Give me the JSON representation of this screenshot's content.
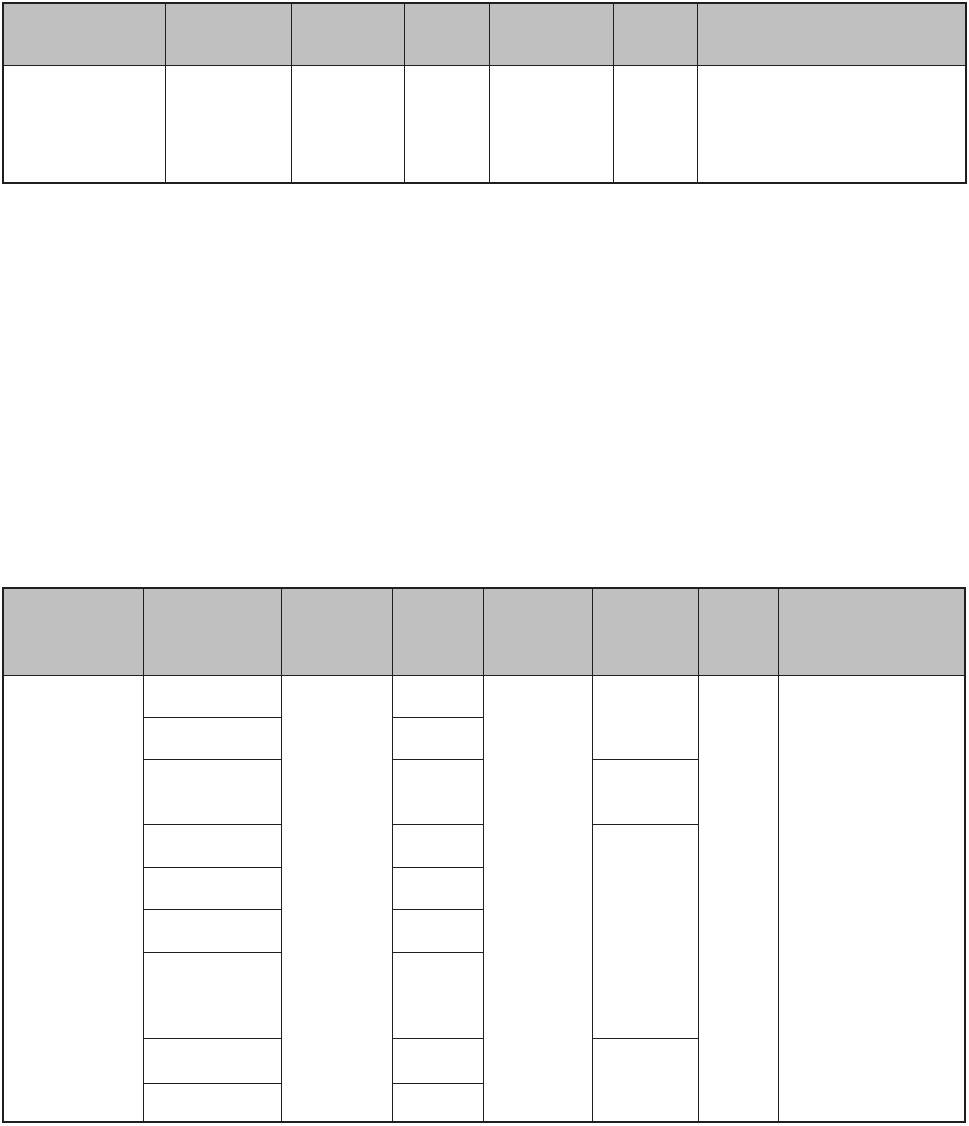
{
  "page": {
    "background_color": "#ffffff",
    "table_border_color": "#1f1f1f",
    "header_fill_color": "#c0c0c0",
    "body_fill_color": "#ffffff",
    "description": "Blank document page containing two empty form tables with gray header rows"
  },
  "top_table": {
    "column_count": 7,
    "header_cells": [
      "",
      "",
      "",
      "",
      "",
      "",
      ""
    ],
    "body_cells": [
      "",
      "",
      "",
      "",
      "",
      "",
      ""
    ]
  },
  "bottom_table": {
    "column_count": 8,
    "header_cells": [
      "",
      "",
      "",
      "",
      "",
      "",
      "",
      ""
    ],
    "col1_cell": "",
    "col2_cells": [
      "",
      "",
      "",
      "",
      "",
      "",
      "",
      "",
      ""
    ],
    "col3_cell": "",
    "col4_cells": [
      "",
      "",
      "",
      "",
      "",
      "",
      "",
      "",
      ""
    ],
    "col5_cell": "",
    "col6_cells": [
      "",
      "",
      "",
      ""
    ],
    "col7_cell": "",
    "col8_cell": ""
  }
}
